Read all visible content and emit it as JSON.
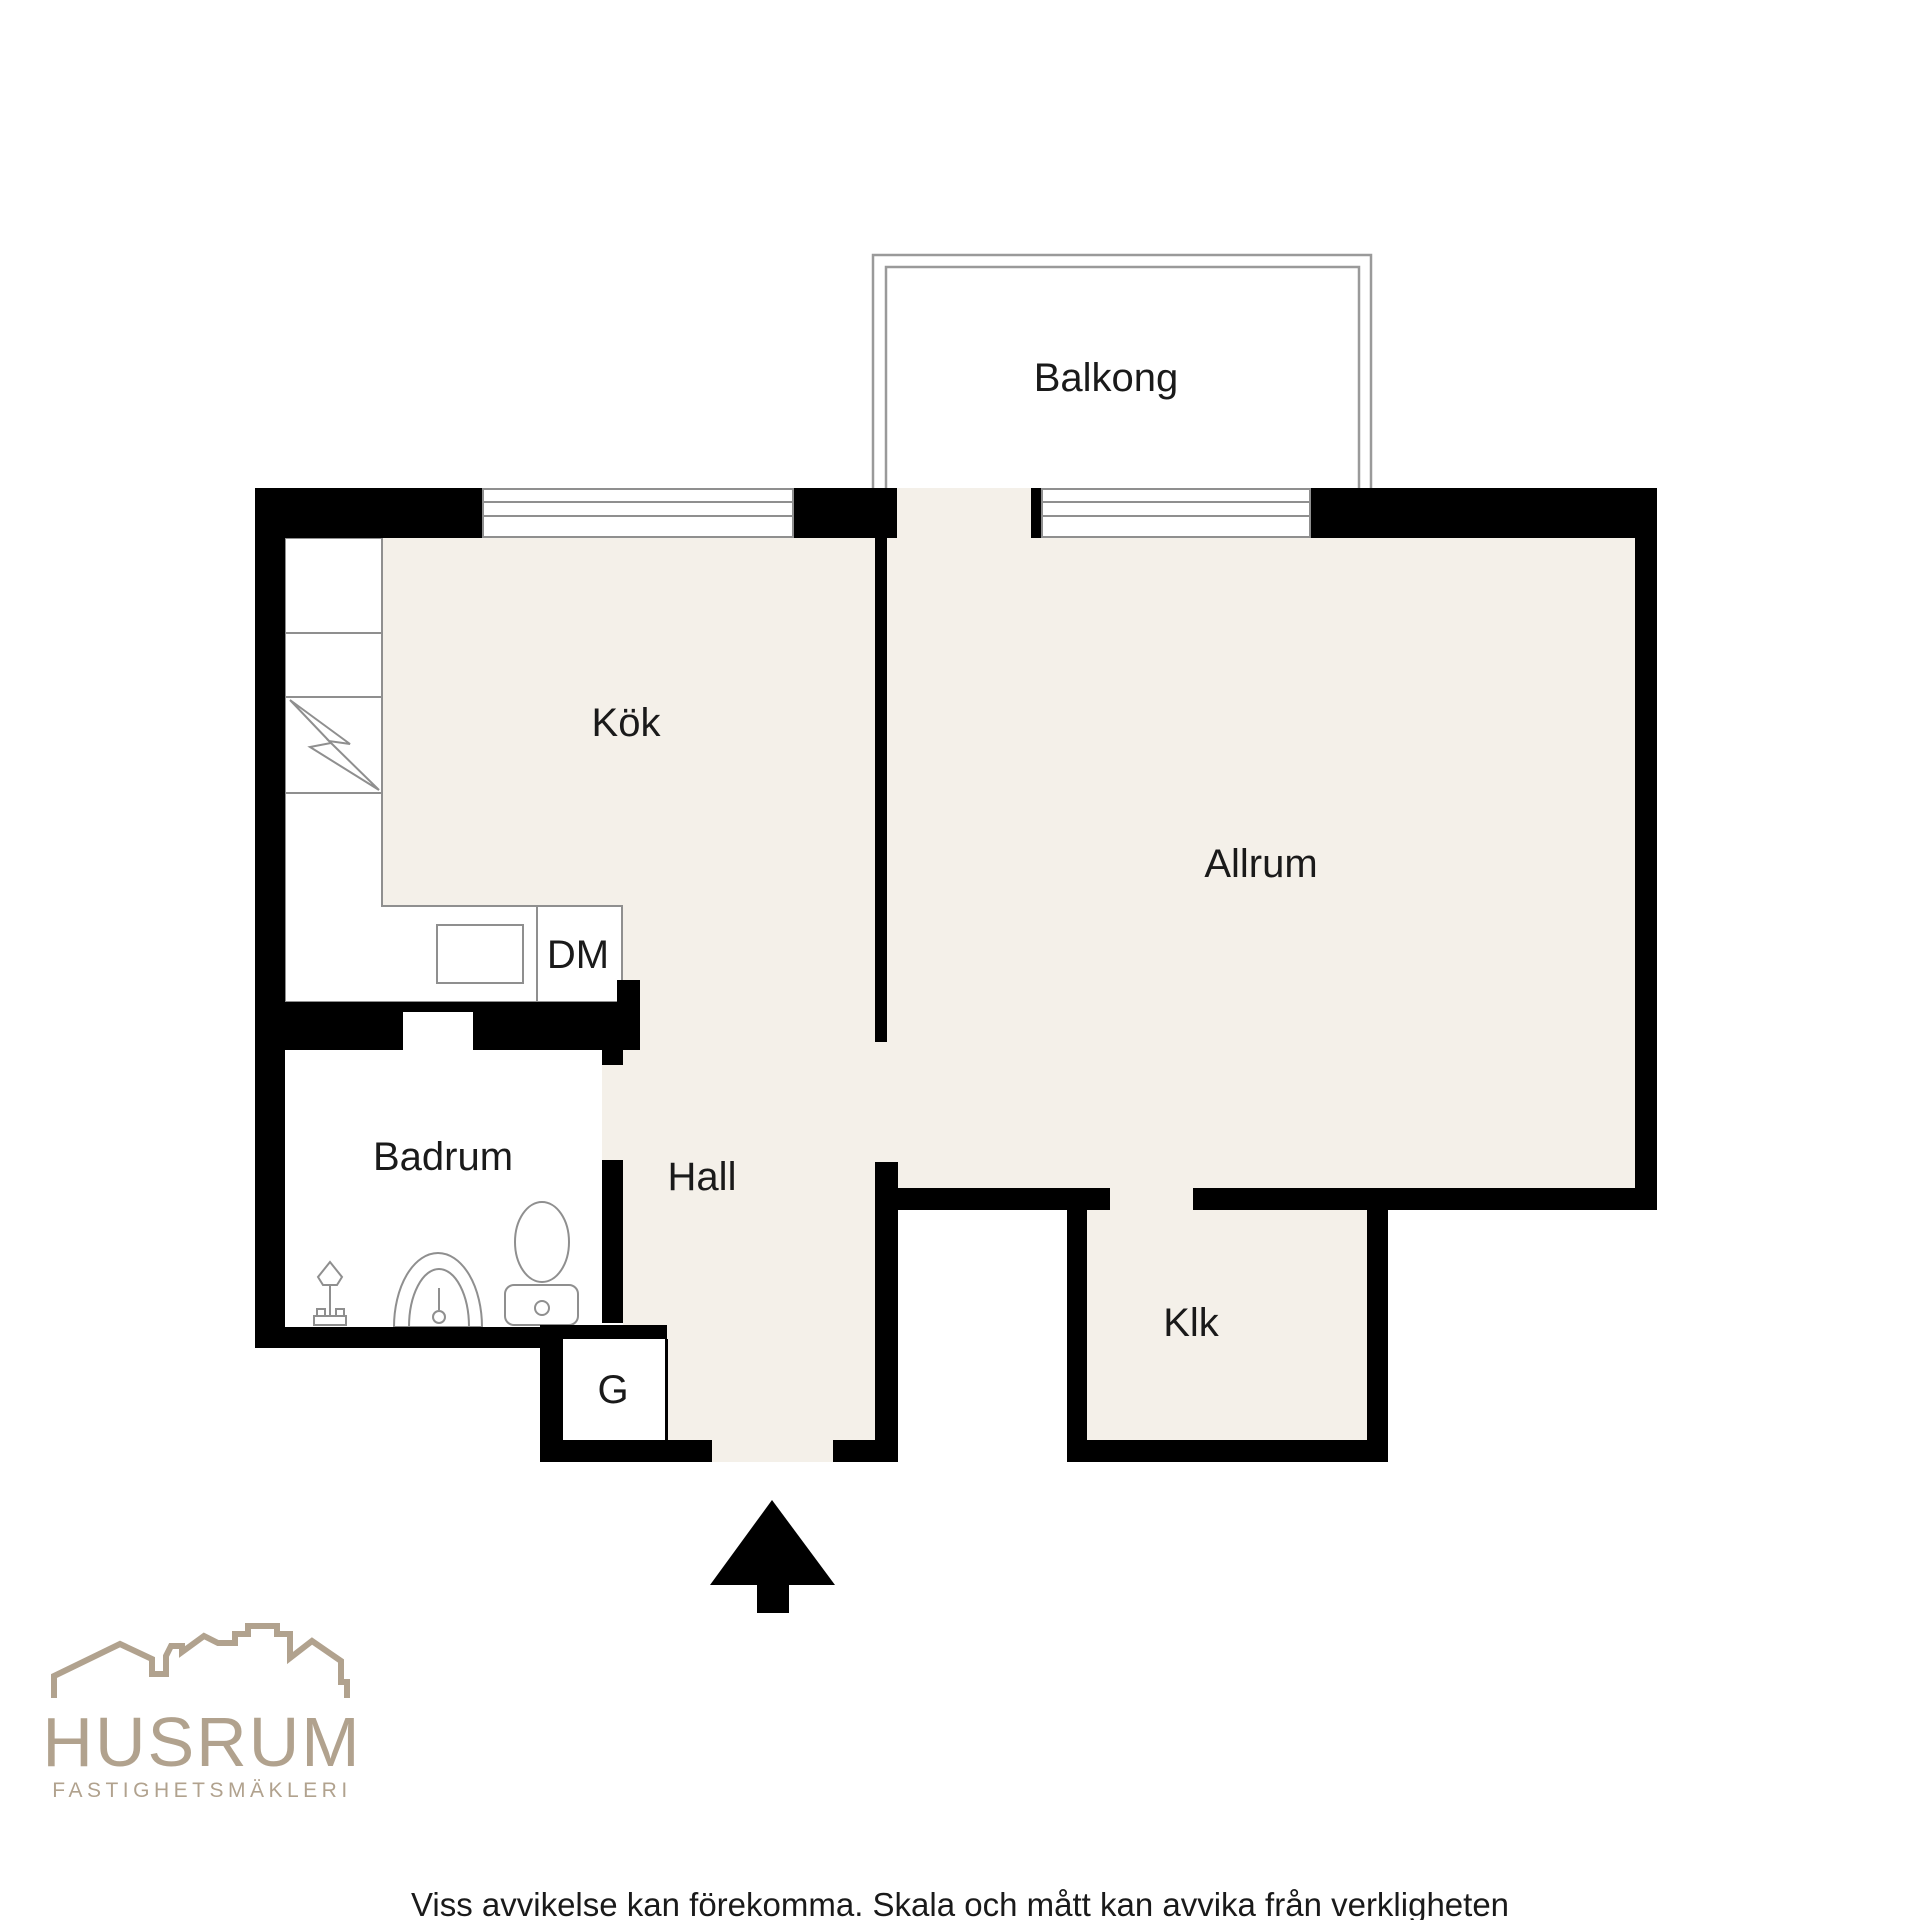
{
  "floorplan": {
    "labels": {
      "balcony": "Balkong",
      "kitchen": "Kök",
      "living_room": "Allrum",
      "bathroom": "Badrum",
      "hall": "Hall",
      "closet": "Klk",
      "wardrobe": "G",
      "dishwasher": "DM"
    },
    "colors": {
      "floor": "#f4f0e9",
      "wall": "#000000",
      "fixture_outline": "#8f8f8f",
      "label_text": "#1a1a1a",
      "bathroom_floor": "#ffffff"
    }
  },
  "branding": {
    "logo_text": "HUSRUM",
    "logo_subtitle": "FASTIGHETSMÄKLERI",
    "logo_color": "#b1a28e"
  },
  "footer": {
    "disclaimer": "Viss avvikelse kan förekomma. Skala och mått kan avvika från verkligheten"
  }
}
